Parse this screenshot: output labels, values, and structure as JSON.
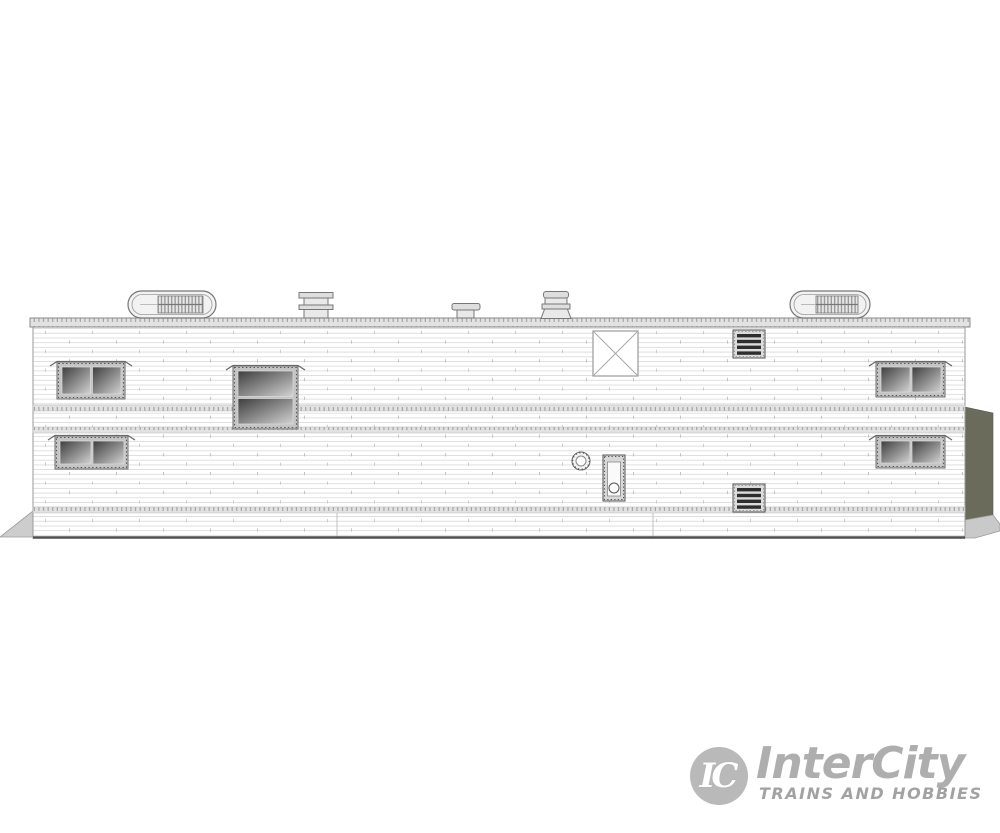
{
  "page": {
    "background": "#ffffff"
  },
  "logo": {
    "initials": "IC",
    "name": "InterCity",
    "tagline": "TRAINS AND HOBBIES",
    "circle_color": "#b9b9b9",
    "name_color": "#aeaeae",
    "tagline_color": "#a2a2a2"
  },
  "colors": {
    "outline": "#8a8a8a",
    "siding_line": "#d8d8d8",
    "roof_strip": "#dcdcdc",
    "belt_band": "#e2e2e2",
    "glass_dark": "#3e3e3e",
    "glass_light": "#d2d2d2",
    "end_panel": "#6b6b5b",
    "shadow_wedge": "#cbcbcb",
    "bottom_rail": "#4f4f4f",
    "louver_slat": "#2e2e2e"
  },
  "components": [
    "roof-pod-vent-left",
    "smoke-jack-stack",
    "mushroom-vent",
    "water-heater-vent",
    "roof-pod-vent-right",
    "roof-hatch-x-panel",
    "louver-vent-upper",
    "louver-vent-lower",
    "window-left-upper",
    "window-left-lower",
    "window-center-large",
    "window-right-upper",
    "window-right-lower",
    "round-port-fitting",
    "utility-door",
    "end-wall-panel",
    "ground-wedge-left",
    "ground-wedge-right"
  ]
}
